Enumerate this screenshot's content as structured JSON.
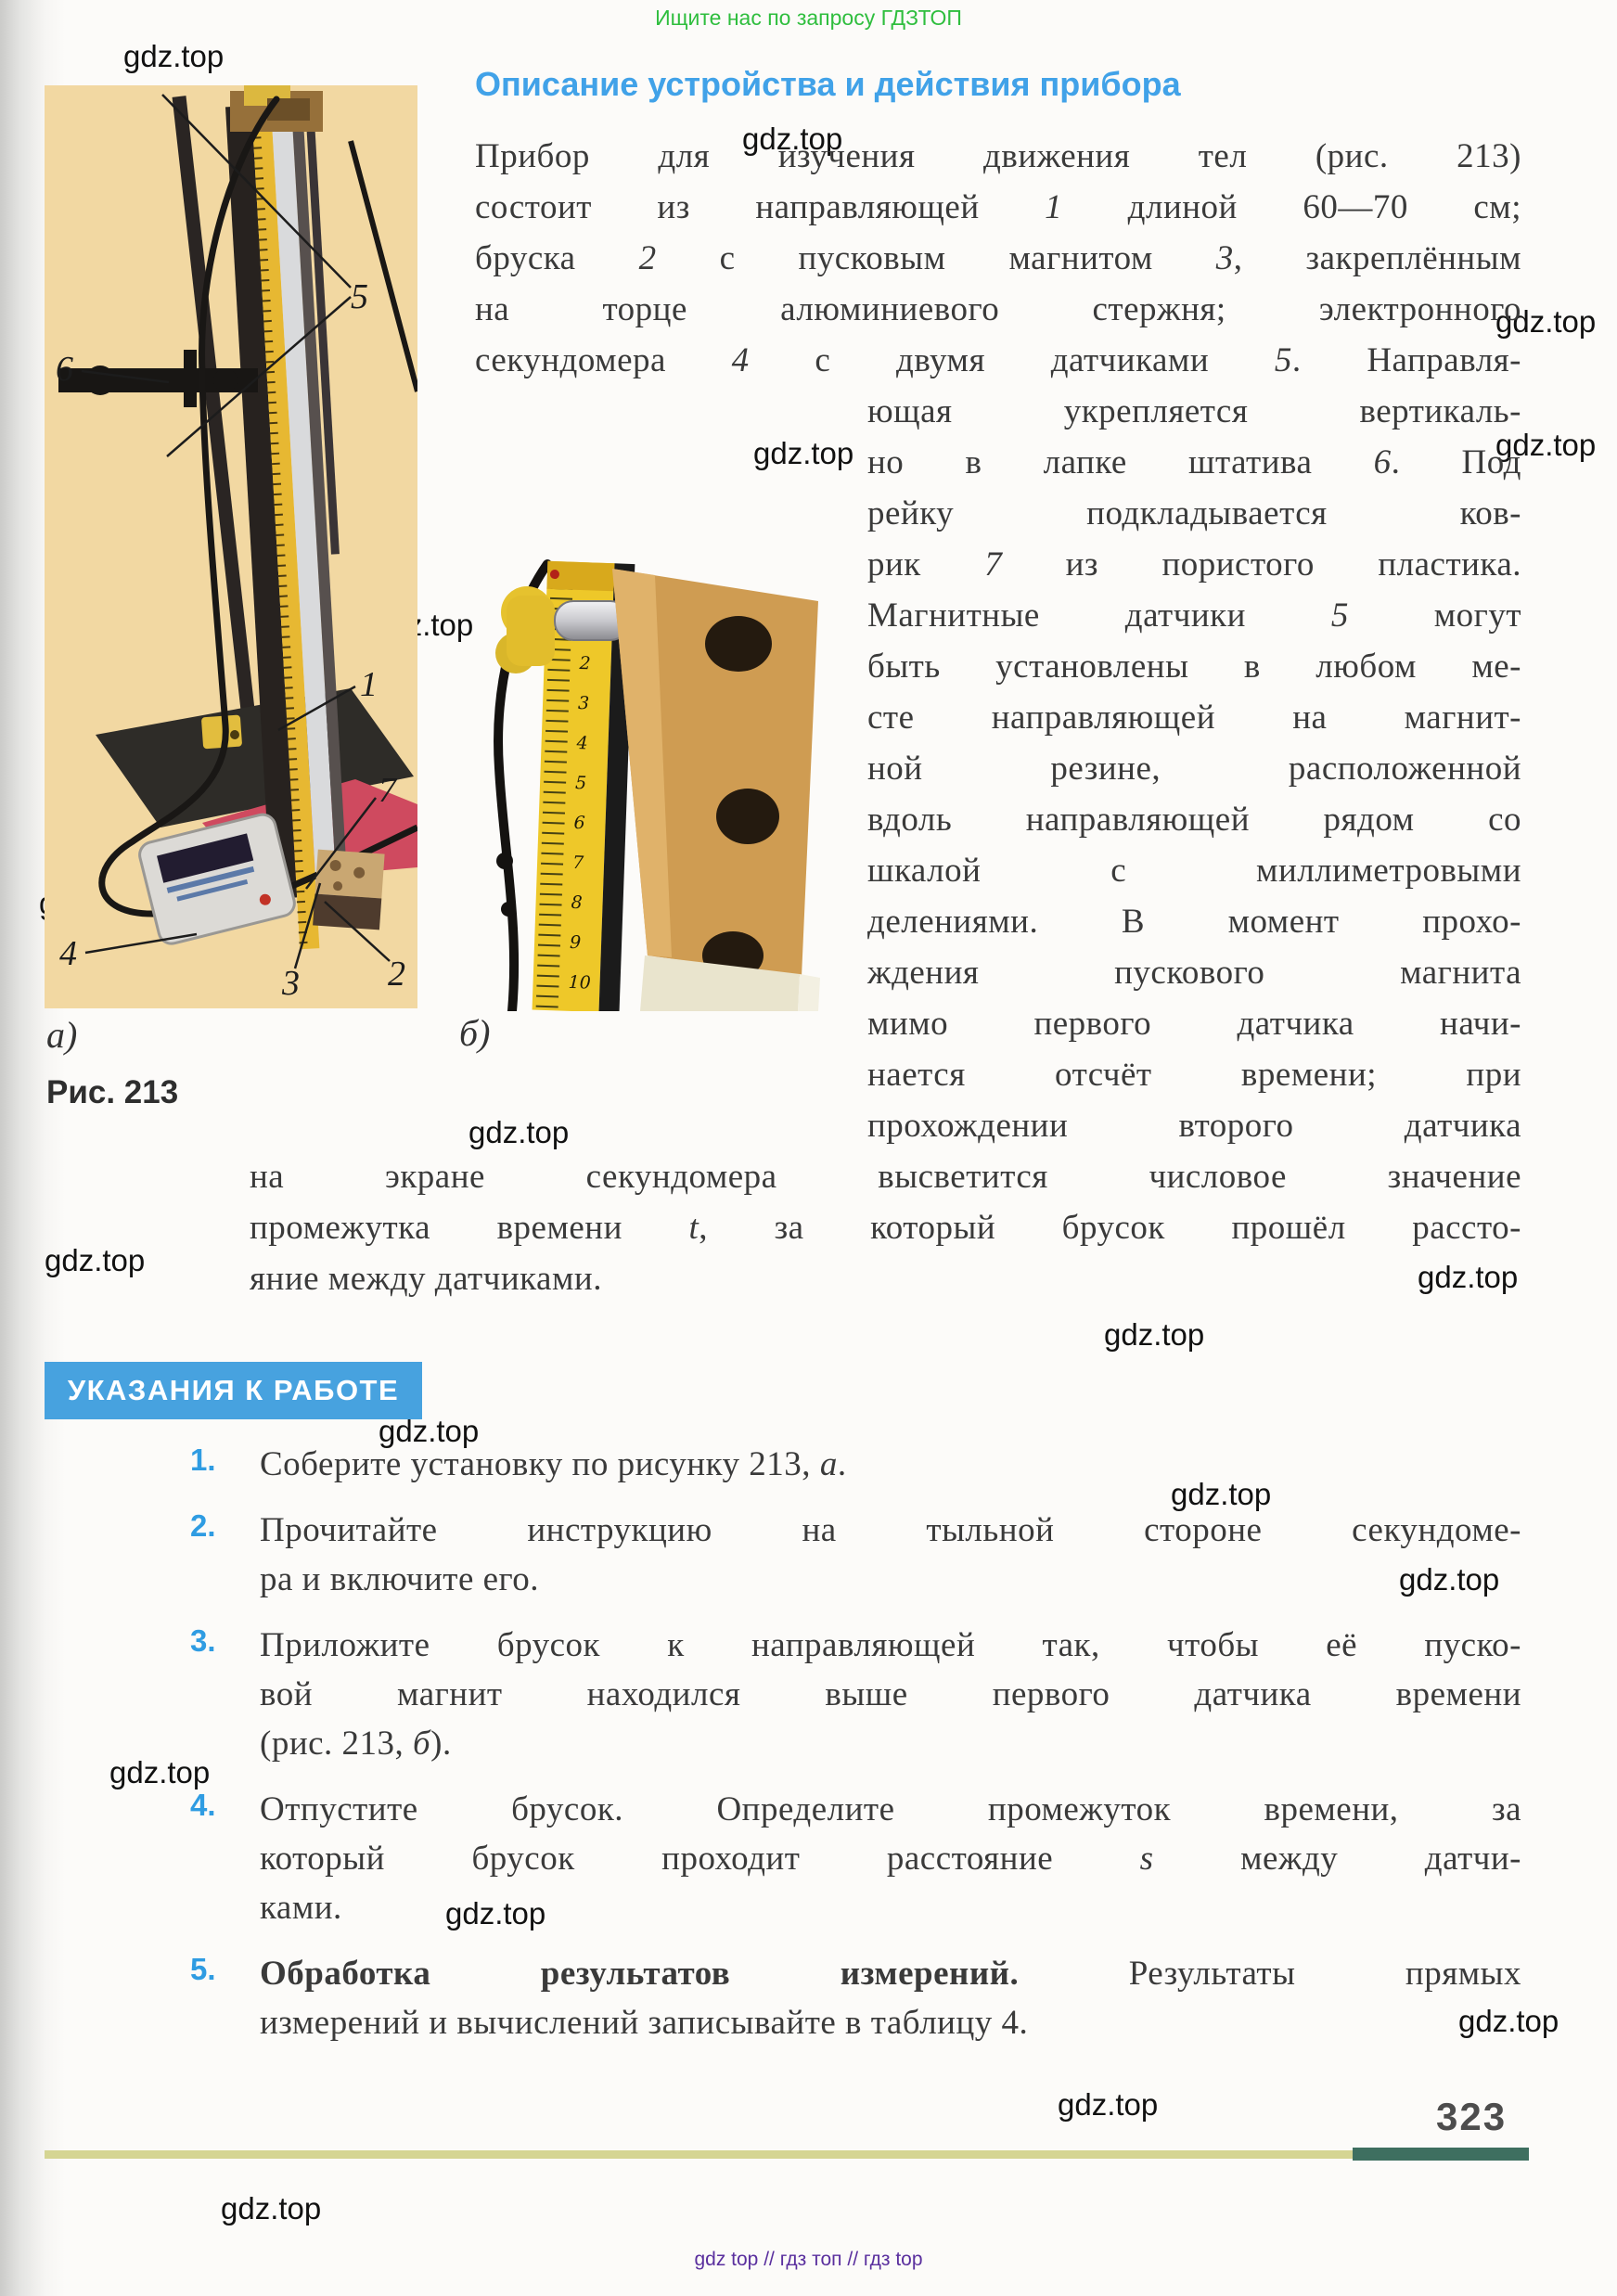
{
  "page": {
    "promo_top": "Ищите нас по запросу ГДЗТОП",
    "footer": "gdz top  //  гдз топ  //  гдз top",
    "page_number": "323",
    "watermark": "gdz.top"
  },
  "heading": "Описание устройства и действия прибора",
  "body": {
    "full_lines": [
      "Прибор для изучения движения тел (рис. 213)",
      "состоит из направляющей *1* длиной 60—70 см;",
      "бруска *2* с пусковым магнитом *3*, закреплённым",
      "на торце алюминиевого стержня; электронного",
      "секундомера *4* с двумя датчиками *5*. Направля-"
    ],
    "narrow_lines": [
      "ющая укрепляется вертикаль-",
      "но в лапке штатива *6*. Под",
      "рейку подкладывается ков-",
      "рик *7* из пористого пластика.",
      "Магнитные датчики *5* могут",
      "быть установлены в любом ме-",
      "сте направляющей на магнит-",
      "ной резине, расположенной",
      "вдоль направляющей рядом со",
      "шкалой с миллиметровыми",
      "делениями. В момент прохо-",
      "ждения пускового магнита",
      "мимо первого датчика начи-",
      "нается отсчёт времени; при",
      "прохождении второго датчика"
    ],
    "tail_lines": [
      "на экране секундомера высветится числовое значение",
      "промежутка времени *t*, за который брусок прошёл рассто-",
      "яние между датчиками."
    ]
  },
  "figure": {
    "caption_a": "а)",
    "caption_b": "б)",
    "caption_fig": "Рис. 213",
    "labels": {
      "l1": "1",
      "l2": "2",
      "l3": "3",
      "l4": "4",
      "l5": "5",
      "l6": "6",
      "l7": "7"
    },
    "ruler_numbers": [
      "1",
      "2",
      "3",
      "4",
      "5",
      "6",
      "7",
      "8",
      "9",
      "10"
    ]
  },
  "worksection": {
    "banner": "УКАЗАНИЯ К РАБОТЕ",
    "items": [
      {
        "num": "1.",
        "lines": [
          "Соберите установку по рисунку 213, *а*."
        ]
      },
      {
        "num": "2.",
        "lines": [
          "Прочитайте инструкцию на тыльной стороне секундоме-",
          "ра и включите его."
        ]
      },
      {
        "num": "3.",
        "lines": [
          "Приложите брусок к направляющей так, чтобы её пуско-",
          "вой магнит находился выше первого датчика времени",
          "(рис. 213, *б*)."
        ]
      },
      {
        "num": "4.",
        "lines": [
          "Отпустите брусок. Определите промежуток времени, за",
          "который брусок проходит расстояние *s* между датчи-",
          "ками."
        ]
      },
      {
        "num": "5.",
        "lines": [
          "**Обработка результатов измерений.** Результаты прямых",
          "измерений и вычислений записывайте в таблицу 4."
        ]
      }
    ]
  },
  "colors": {
    "heading_blue": "#41a2e8",
    "banner_blue": "#47a2df",
    "list_number_blue": "#2f9ce2",
    "promo_green": "#2fbe3e",
    "footer_purple": "#5a2f9e",
    "rule_olive": "#d5d593",
    "rule_teal": "#3e6f60",
    "photo_bg_tan": "#f2d8a2",
    "mat_pink": "#cf4a5f",
    "tape_yellow": "#eec829"
  }
}
